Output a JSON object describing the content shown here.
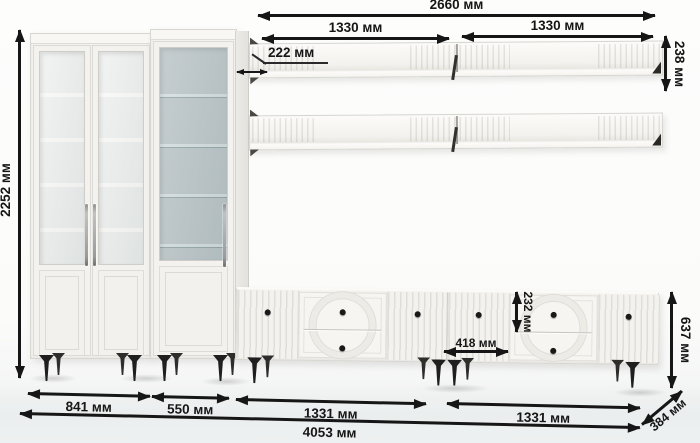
{
  "units": "мм",
  "dims": {
    "shelves_total": "2660 мм",
    "shelf_left": "1330 мм",
    "shelf_right": "1330 мм",
    "shelf_height": "238 мм",
    "shelf_depth": "222 мм",
    "total_height": "2252 мм",
    "top_drawer_height": "232 мм",
    "drawer_section_offset": "418 мм",
    "tv_stand_height": "637 мм",
    "tv_stand_depth": "384 мм",
    "bookcase_width": "841 мм",
    "display_cabinet_width": "550 мм",
    "tv_stand_left_width": "1331 мм",
    "tv_stand_right_width": "1331 мм",
    "total_width": "4053 мм"
  },
  "colors": {
    "dimension_ink": "#161616",
    "furniture_white": "#f3f2ee",
    "glass_tint": "#b9c3c5",
    "legs_black": "#1f1f1f"
  }
}
